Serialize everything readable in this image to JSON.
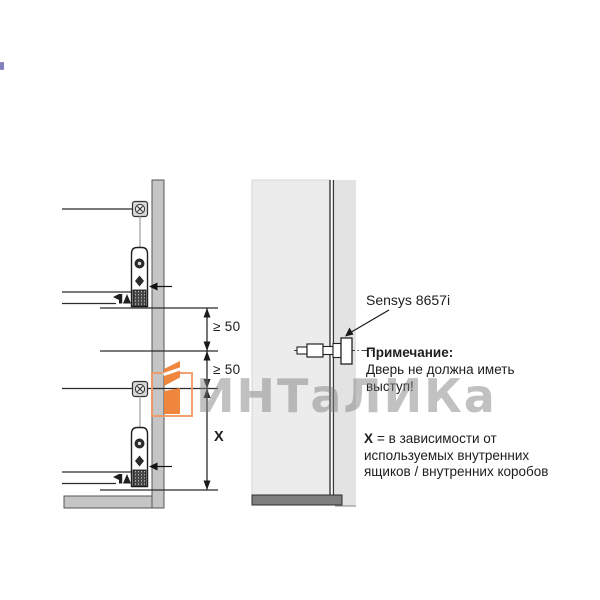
{
  "drawing_left": {
    "dims": {
      "seg1": "≥ 50",
      "seg2": "≥ 50",
      "x_label": "X"
    }
  },
  "drawing_right": {
    "hinge_label": "Sensys 8657i",
    "note": {
      "title": "Примечание:",
      "line1": "Дверь не должна иметь",
      "line2": "выступ!"
    },
    "legend": {
      "x_bold": "X",
      "line1_rest": "= в зависимости от",
      "line2": "используемых внутренних",
      "line3": "ящиков / внутренних коробов"
    }
  },
  "watermark": {
    "text": "ИНТаЛИКа",
    "logo_icon": "intalika-logo",
    "orange_hex": "#ee7c2d",
    "orange_outline_hex": "#f19a62",
    "text_gray_hex": "#7d7d7d"
  },
  "icons": {
    "mounting_screw": "cross-screw-icon",
    "hinge": "sensys-hinge-icon",
    "dimension_arrows": "dimension-arrowhead-icon",
    "panel_pointer": "panel-arrow-icon"
  },
  "colors": {
    "line": "#2b2b2b",
    "side_panel_fill": "#c5c5c5",
    "door_fill": "#ececec",
    "edge_strip_fill": "#e3e3e3",
    "door_bottom_bar": "#7e7e7e"
  }
}
